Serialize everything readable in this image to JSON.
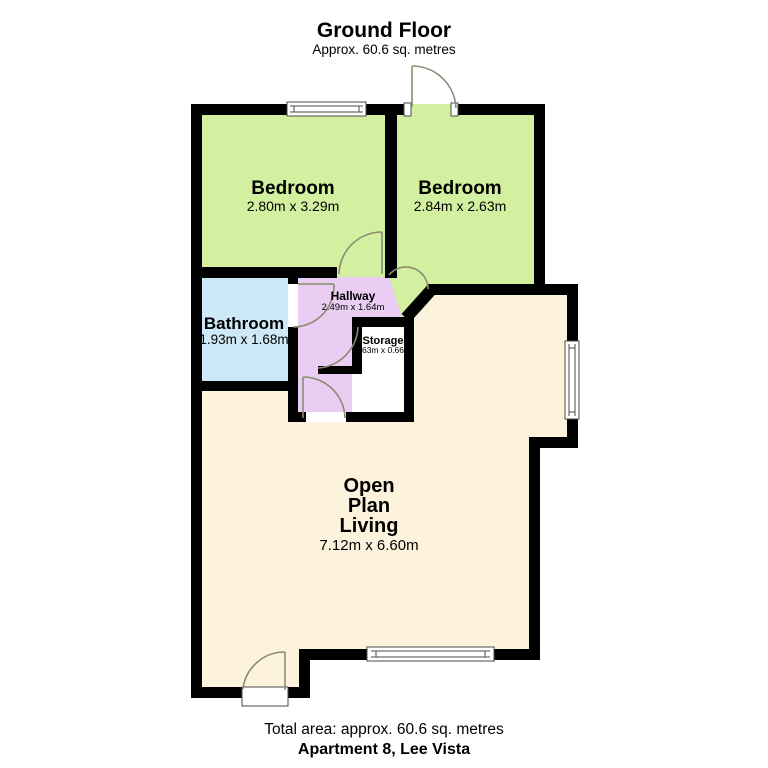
{
  "header": {
    "title": "Ground Floor",
    "subtitle": "Approx. 60.6 sq. metres"
  },
  "footer": {
    "total_area": "Total area: approx. 60.6 sq. metres",
    "address": "Apartment 8, Lee Vista"
  },
  "rooms": {
    "bedroom1": {
      "name": "Bedroom",
      "dims": "2.80m x 3.29m",
      "color": "#d3efa0"
    },
    "bedroom2": {
      "name": "Bedroom",
      "dims": "2.84m x 2.63m",
      "color": "#d3efa0"
    },
    "bathroom": {
      "name": "Bathroom",
      "dims": "1.93m x 1.68m",
      "color": "#cde8f6"
    },
    "hallway": {
      "name": "Hallway",
      "dims": "2.49m x 1.64m",
      "color": "#e9cdf3"
    },
    "storage": {
      "name": "Storage",
      "dims": "1.63m x 0.66m",
      "color": "#ffffff"
    },
    "living": {
      "name_lines": [
        "Open",
        "Plan",
        "Living"
      ],
      "dims": "7.12m x 6.60m",
      "color": "#fdf3dd"
    }
  },
  "colors": {
    "wall": "#000000",
    "door_arc": "#8b8c72",
    "window_frame": "#4a4a4a",
    "text": "#000000"
  }
}
